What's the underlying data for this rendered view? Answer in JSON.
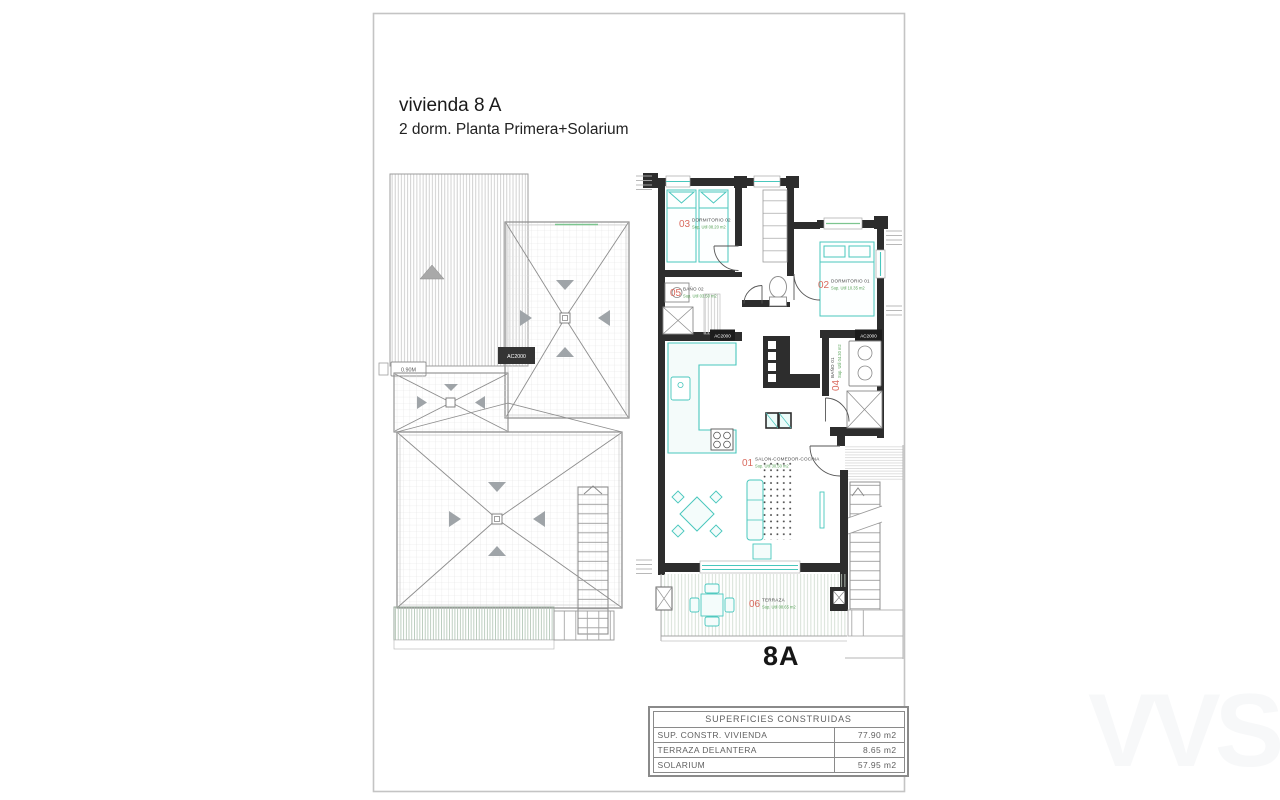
{
  "page": {
    "title_line1": "vivienda 8 A",
    "title_line2": "2 dorm.  Planta Primera+Solarium",
    "unit_label": "8A",
    "watermark": "VVS"
  },
  "colors": {
    "wall": "#2d2d2d",
    "furniture_teal": "#49c7bd",
    "room_number_red": "#d96a5e",
    "area_green": "#57a257"
  },
  "rooms": {
    "salon": {
      "num": "01",
      "name": "SALON-COMEDOR-COCINA",
      "area": "Sup. Util 30.50 m2"
    },
    "dorm1": {
      "num": "02",
      "name": "DORMITORIO 01",
      "area": "Sup. Util 10.35 m2"
    },
    "dorm2": {
      "num": "03",
      "name": "DORMITORIO 02",
      "area": "Sup. Util 08.20 m2"
    },
    "bano1": {
      "num": "04",
      "name": "BAÑO 01",
      "area": "Sup. Util 04.30 m2"
    },
    "bano2": {
      "num": "05",
      "name": "BAÑO 02",
      "area": "Sup. Util 03.50 m2"
    },
    "terraza": {
      "num": "06",
      "name": "TERRAZA",
      "area": "Sup. Util 08.65 m2"
    }
  },
  "equipment": {
    "ac_roof": "AC2000",
    "ac_hall": "AC2000",
    "ac_dorm": "AC2000",
    "door_tag": "0.90M"
  },
  "surfaces_table": {
    "header": "SUPERFICIES CONSTRUIDAS",
    "rows": [
      {
        "label": "SUP. CONSTR. VIVIENDA",
        "value": "77.90 m2"
      },
      {
        "label": "TERRAZA DELANTERA",
        "value": "8.65 m2"
      },
      {
        "label": "SOLARIUM",
        "value": "57.95 m2"
      }
    ]
  }
}
